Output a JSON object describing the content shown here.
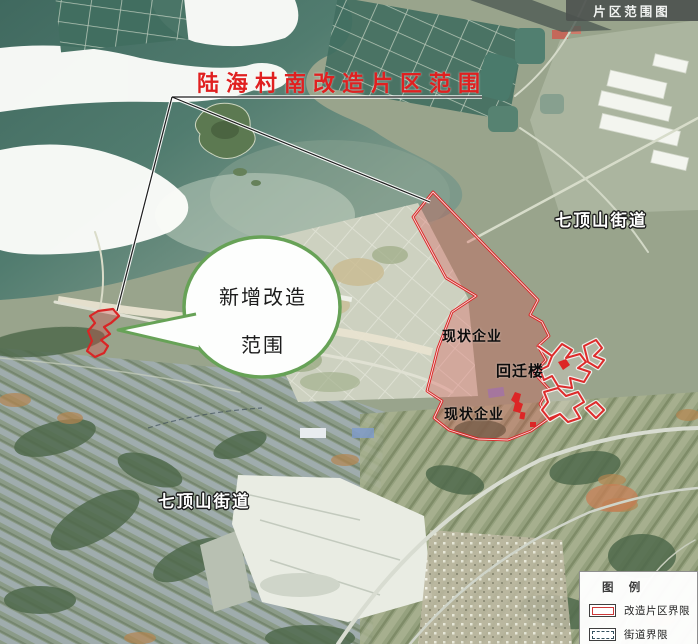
{
  "tab": {
    "title": "片区范围图"
  },
  "annotations": {
    "main_title": "陆海村南改造片区范围",
    "callout_line1": "新增改造",
    "callout_line2": "范围",
    "label_enterprise_1": "现状企业",
    "label_relocation": "回迁楼",
    "label_enterprise_2": "现状企业",
    "label_street_tr": "七顶山街道",
    "label_street_bl": "七顶山街道"
  },
  "legend": {
    "title": "图 例",
    "items": [
      {
        "label": "改造片区界限",
        "symbol": "red-rect"
      },
      {
        "label": "街道界限",
        "symbol": "dashed-rect"
      }
    ]
  },
  "colors": {
    "boundary_red": "#d92525",
    "title_red": "#e02020",
    "callout_green": "#67a257",
    "legend_red": "#cd3838",
    "legend_dashed": "#33505e",
    "tab_background": "#4d524f",
    "water_teal": "#4f7a6e"
  }
}
